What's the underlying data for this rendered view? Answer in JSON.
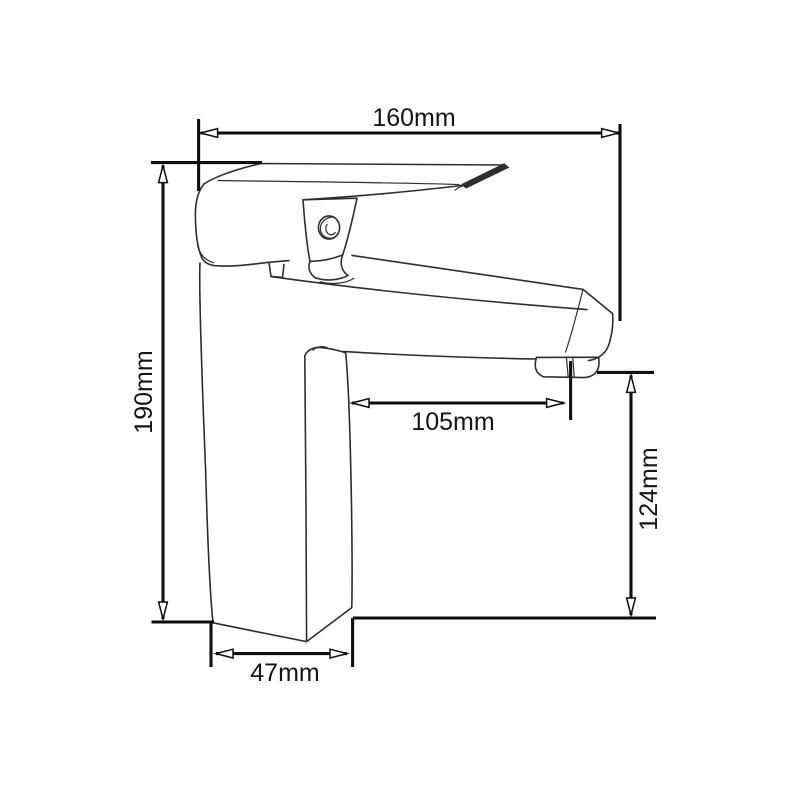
{
  "diagram": {
    "subject": "single-lever basin mixer tap, side elevation technical drawing",
    "background_color": "#ffffff",
    "dimension_line_color": "#0f0f0f",
    "sketch_line_color": "#2e2e2e",
    "label_color": "#141414",
    "dimensions": [
      {
        "id": "overall-width",
        "label": "160mm",
        "orientation": "horizontal"
      },
      {
        "id": "overall-height",
        "label": "190mm",
        "orientation": "vertical"
      },
      {
        "id": "spout-reach",
        "label": "105mm",
        "orientation": "horizontal"
      },
      {
        "id": "outlet-height",
        "label": "124mm",
        "orientation": "vertical"
      },
      {
        "id": "base-width",
        "label": "47mm",
        "orientation": "horizontal"
      }
    ]
  }
}
